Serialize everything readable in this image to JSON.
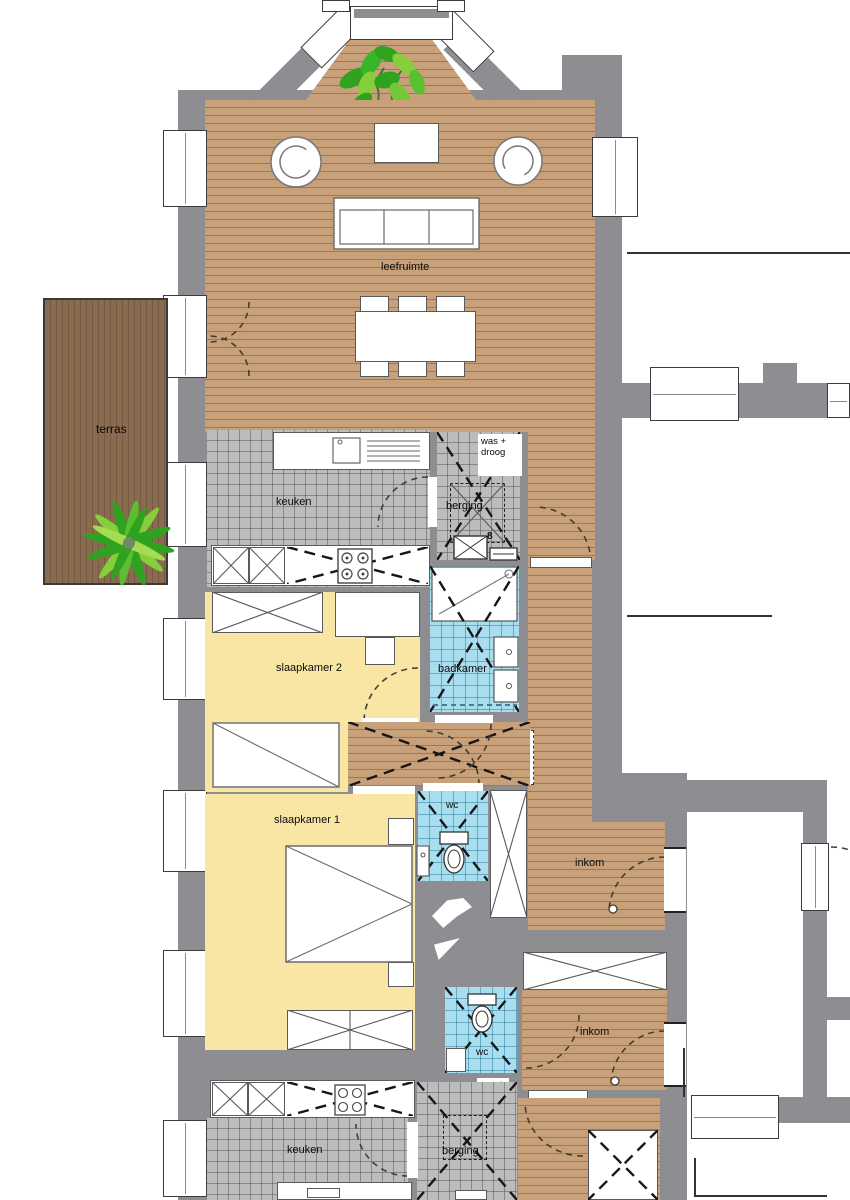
{
  "title": "apartment floor plan",
  "colors": {
    "wall": "#8d8d92",
    "wood_floor": "#c8a17b",
    "terrace_deck": "#8a6b4f",
    "bedroom_floor": "#f9e6a4",
    "kitchen_tile": "#bcbcbc",
    "bathroom_tile": "#a9def0",
    "plant_dark_green": "#2fa31f",
    "plant_light_green": "#86cf3a",
    "outline": "#161616"
  },
  "rooms": {
    "leefruimte": "leefruimte",
    "terras": "terras",
    "keuken": "keuken",
    "berging": "berging",
    "badkamer": "badkamer",
    "slaapkamer1": "slaapkamer 1",
    "slaapkamer2": "slaapkamer 2",
    "wc": "wc",
    "inkom": "inkom",
    "was_droog_line1": "was +",
    "was_droog_line2": "droog",
    "boiler_mark": "8"
  }
}
